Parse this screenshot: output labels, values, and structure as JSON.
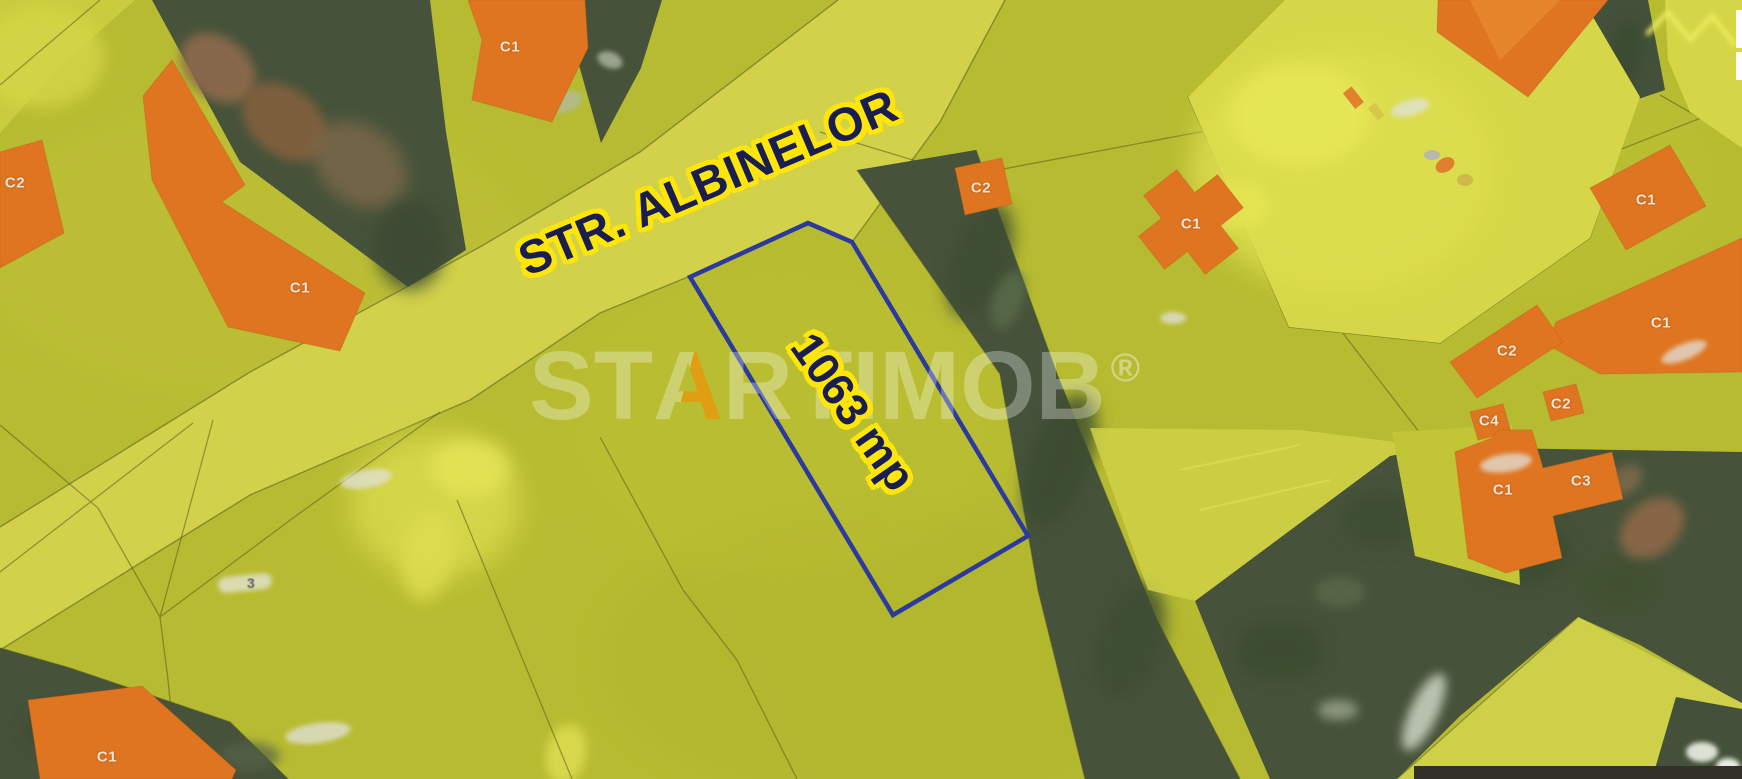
{
  "map": {
    "street_label": "STR. ALBINELOR",
    "plot": {
      "area_label": "1063 mp",
      "outline_color": "#2c3a9e"
    },
    "parcel_house_number_digit": "3",
    "building_labels": [
      {
        "label": "C2"
      },
      {
        "label": "C1"
      },
      {
        "label": "C1"
      },
      {
        "label": "C2"
      },
      {
        "label": "C1"
      },
      {
        "label": "C1"
      },
      {
        "label": "C1"
      },
      {
        "label": "C2"
      },
      {
        "label": "C2"
      },
      {
        "label": "C4"
      },
      {
        "label": "C1"
      },
      {
        "label": "C3"
      },
      {
        "label": "C1"
      }
    ],
    "colors": {
      "parcel_overlay": "#b7bb31",
      "road": "#d2d24b",
      "building_orange": "#df7520",
      "photo_green": "#46533a",
      "label_text": "#191d4f",
      "label_halo": "#ffe60a"
    }
  },
  "watermark": {
    "brand": "STARTIMOB",
    "part_before_a": "ST",
    "letter_a": "A",
    "part_after_a": "RTIMOB",
    "registered": "®",
    "accent_color": "#e8940e"
  }
}
